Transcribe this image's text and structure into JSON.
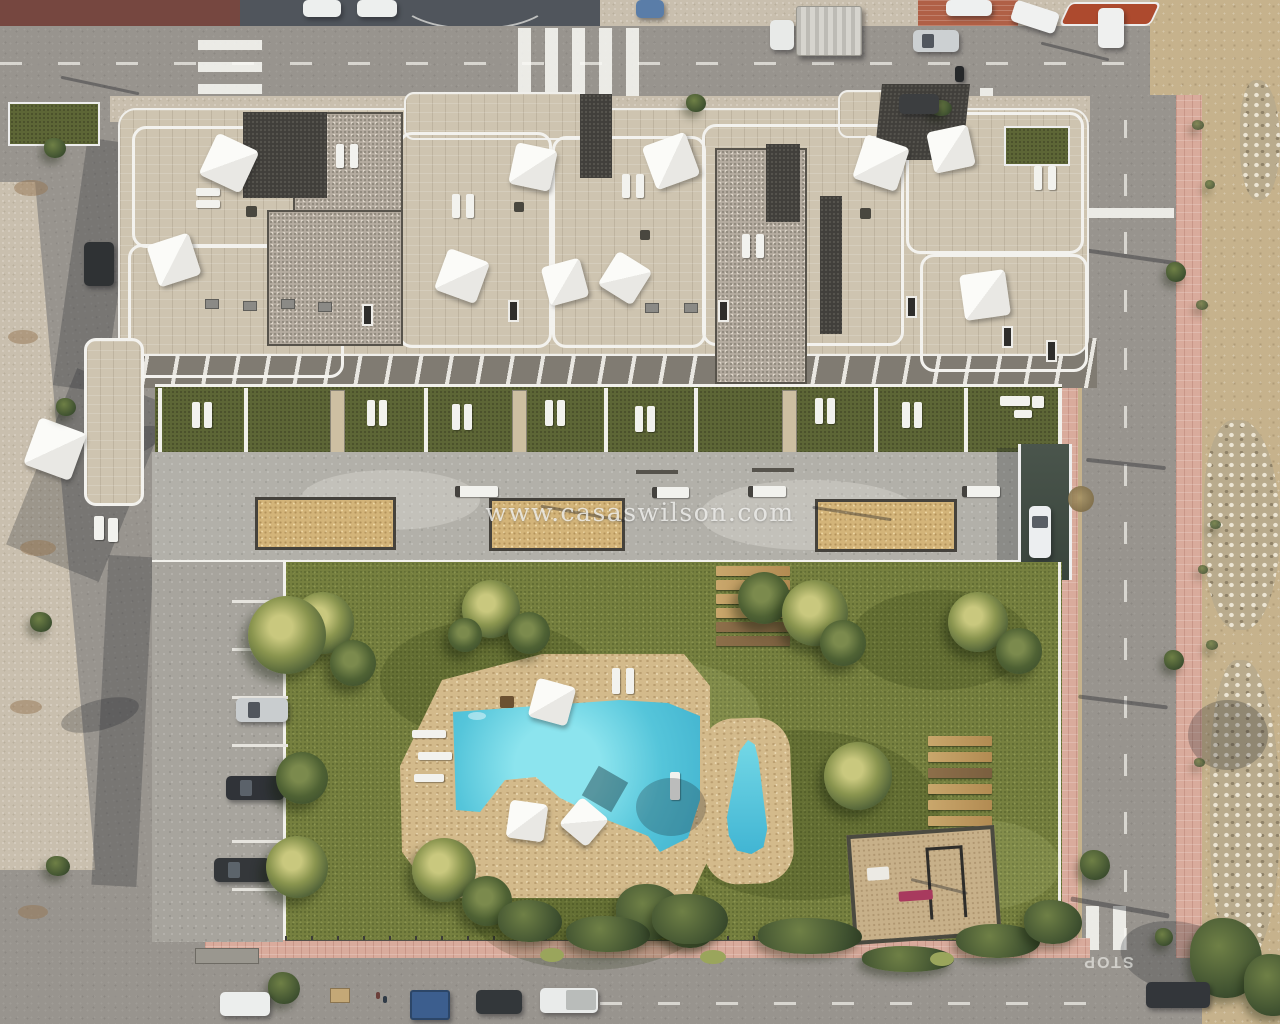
{
  "watermark": {
    "text": "www.casaswilson.com"
  },
  "road_markings": {
    "stop": "STOP"
  },
  "palette": {
    "asphalt": "#98948e",
    "sidewalk": "#c9bfae",
    "pink_pavement": "#d9ab9c",
    "red_island": "#ad4a2e",
    "brick_corner": "#b06046",
    "building_stone": "#cec4b0",
    "gravel_roof": "#b5aca0",
    "dark_roof": "#413f3b",
    "railing_white": "#f3f2ee",
    "lawn": "#76803f",
    "private_garden": "#5d6636",
    "pool_deck": "#d3ba8b",
    "pool_water": "#55c5da",
    "terrace_concrete": "#b2b0a9",
    "planter_sand": "#d3b479",
    "dirt_lot": "#c6b28c",
    "playground_sand": "#c7b089",
    "parasol_white": "#fbfbf8"
  }
}
